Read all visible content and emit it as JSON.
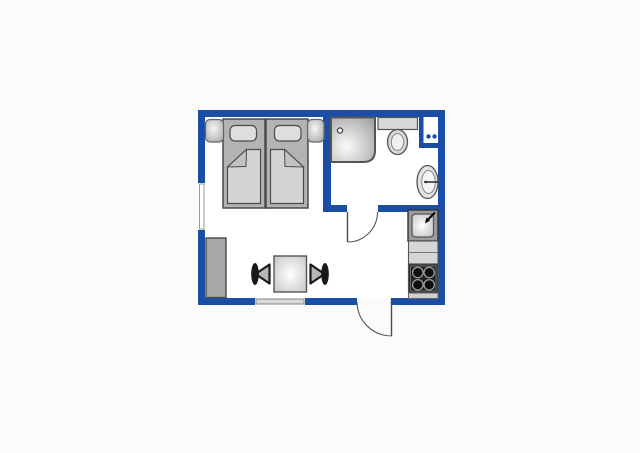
{
  "title": "studio-apartment-floor-plan",
  "colors": {
    "background": "#fbfbf9",
    "wall_blue": "#1a4da6",
    "floor_white": "#ffffff",
    "furniture_mid_gray": "#b3b3b3",
    "furniture_light_gray": "#dedede",
    "blanket_gray": "#d4d4d4",
    "flap_gray": "#c2c2c2",
    "wardrobe_gray": "#a9a9a9",
    "stove_dark": "#222222",
    "burner_black": "#0d0d0d",
    "chair_dark": "#191919",
    "outline_dark": "#4a4a4a",
    "outline_mid": "#555555",
    "window_glaze": "#d9d9d9"
  },
  "floorplan": {
    "outer_bounds_px": {
      "x": 198,
      "y": 110,
      "width": 247,
      "height": 195
    },
    "rooms": [
      {
        "name": "bedroom-living-area",
        "contents": [
          "double-bed",
          "nightstands",
          "wardrobe",
          "dining-table",
          "chairs"
        ]
      },
      {
        "name": "bathroom",
        "contents": [
          "shower",
          "toilet",
          "washbasin",
          "utility-box"
        ]
      },
      {
        "name": "kitchenette",
        "contents": [
          "kitchen-sink",
          "counter",
          "stove"
        ]
      }
    ],
    "fixtures": [
      {
        "name": "twin-bed-left",
        "bbox": [
          223,
          119,
          42,
          89
        ]
      },
      {
        "name": "twin-bed-right",
        "bbox": [
          266,
          119,
          42,
          89
        ]
      },
      {
        "name": "nightstand-left",
        "bbox": [
          205,
          119,
          18,
          23
        ]
      },
      {
        "name": "nightstand-right",
        "bbox": [
          307,
          119,
          17,
          23
        ]
      },
      {
        "name": "shower",
        "bbox": [
          331,
          117,
          44,
          45
        ]
      },
      {
        "name": "toilet",
        "bbox": [
          378,
          117,
          40,
          38
        ]
      },
      {
        "name": "utility-box-with-dots",
        "bbox": [
          419,
          117,
          19,
          31
        ]
      },
      {
        "name": "washbasin",
        "bbox": [
          417,
          165,
          21,
          34
        ]
      },
      {
        "name": "kitchen-sink-unit",
        "bbox": [
          408,
          210,
          30,
          31
        ]
      },
      {
        "name": "kitchen-counter",
        "bbox": [
          408,
          241,
          30,
          23
        ]
      },
      {
        "name": "stove-four-burners",
        "bbox": [
          408,
          264,
          30,
          29
        ]
      },
      {
        "name": "stove-base",
        "bbox": [
          408,
          293,
          30,
          6
        ]
      },
      {
        "name": "wardrobe",
        "bbox": [
          206,
          238,
          20,
          60
        ]
      },
      {
        "name": "dining-table",
        "bbox": [
          274,
          256,
          33,
          36
        ]
      },
      {
        "name": "chair-left",
        "bbox": [
          251,
          263,
          19,
          22
        ]
      },
      {
        "name": "chair-right",
        "bbox": [
          310,
          263,
          19,
          22
        ]
      },
      {
        "name": "window-left-wall",
        "bbox": [
          198,
          183,
          7,
          47
        ]
      },
      {
        "name": "window-bottom-wall",
        "bbox": [
          255,
          298,
          50,
          7
        ]
      },
      {
        "name": "entrance-door",
        "opening": [
          357,
          392
        ],
        "swing": "outward-south",
        "hinge": "east"
      },
      {
        "name": "bathroom-door",
        "opening": [
          347,
          378
        ],
        "swing": "inward-south",
        "hinge": "west"
      }
    ]
  }
}
